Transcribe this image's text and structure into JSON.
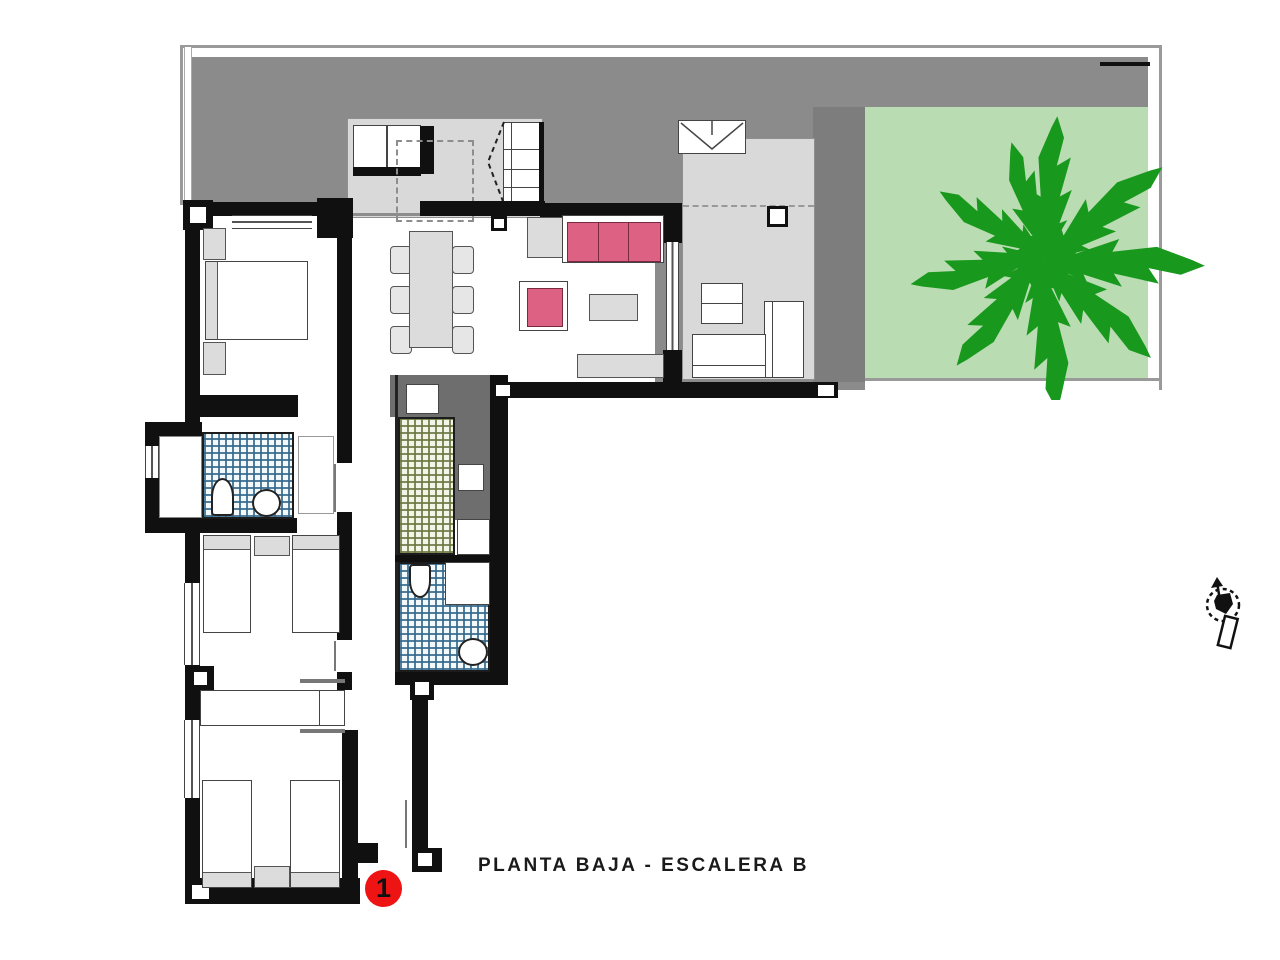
{
  "title": {
    "caption": "PLANTA BAJA - ESCALERA B"
  },
  "marker": {
    "label": "1"
  },
  "icons": {
    "compass": "north-compass-icon",
    "tree": "garden-tree-icon"
  },
  "colors": {
    "wall": "#101010",
    "roof": "#8b8b8b",
    "strip": "#7d7d7d",
    "counter": "#6e6e6e",
    "terraceFloor": "#d9d9d9",
    "furniture": "#dcdcdc",
    "garden": "#b9dcb2",
    "tree": "#18981c",
    "tileBlueLine": "#34688c",
    "tileOliveLine": "#6c7842",
    "sofaPink": "#dd6183",
    "markerRed": "#ee1414",
    "text": "#1a1a1a"
  }
}
